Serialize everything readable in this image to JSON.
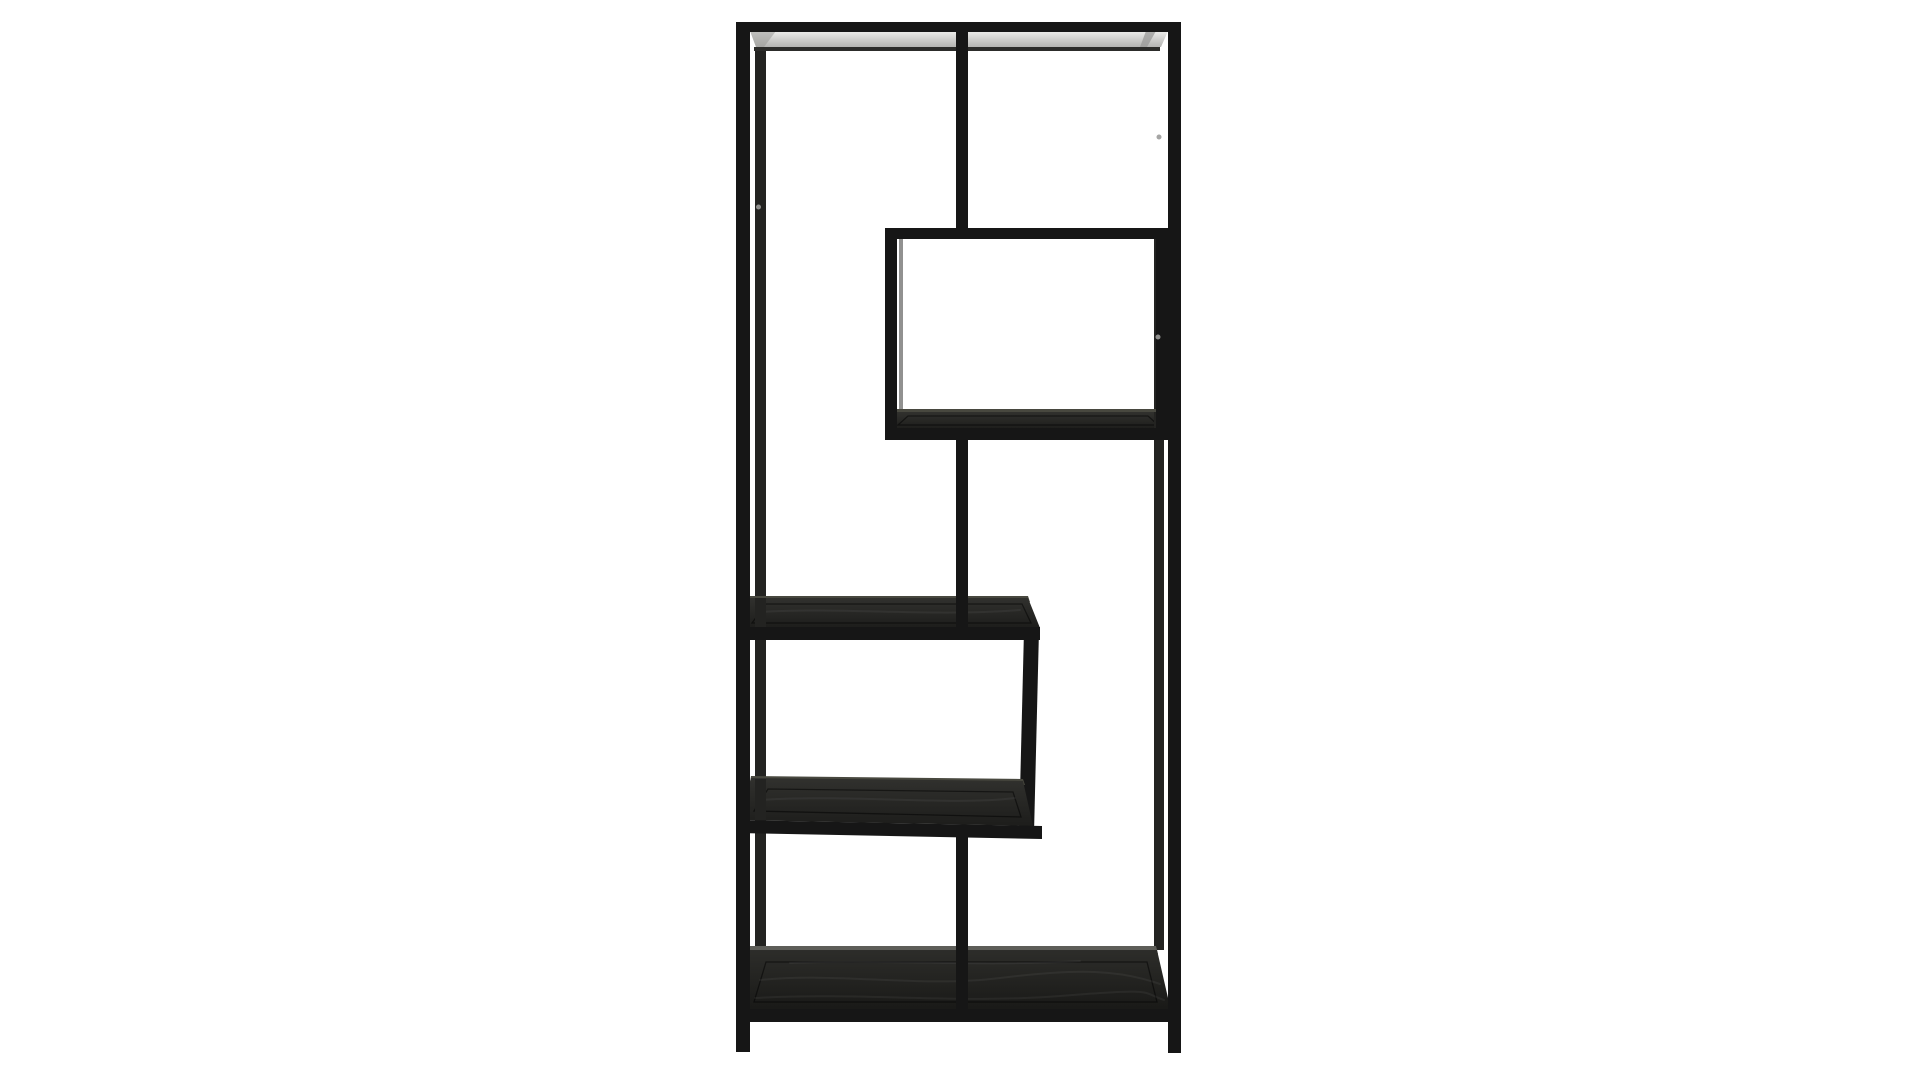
{
  "scene": {
    "type": "product-photo",
    "label": "Tall asymmetric black metal bookshelf with five staggered dark wood shelves, photographed on a plain white background",
    "object": "asymmetric-etagere-bookcase",
    "background": "white seamless studio backdrop",
    "shelf_count": 5,
    "visible_parts": [
      "black metal frame",
      "full-width top shelf",
      "upper-right box shelf",
      "middle-left box shelf",
      "full-width bottom shelf",
      "front legs"
    ]
  },
  "colors": {
    "background": "#ffffff",
    "frame": "#161616",
    "frame_back": "#232321",
    "face_light": "#31312e",
    "face_dark": "#1d1d1b",
    "bottom_face_light": "#2d2d2a",
    "bottom_face_dark": "#191917",
    "edge_highlight": "#48483f",
    "edge_highlight_bright": "#5d5d58",
    "under_shadow": "#2c2c2a",
    "strip_light": "#eeeeec",
    "strip_mid": "#d3d3d1",
    "strip_dark": "#b4b4b2",
    "strip_shade": "#9a9a98",
    "screw_light": "#8f8f8d",
    "inset_line": "rgba(0,0,0,0.5)",
    "grain_line": "rgba(255,255,255,0.05)"
  }
}
